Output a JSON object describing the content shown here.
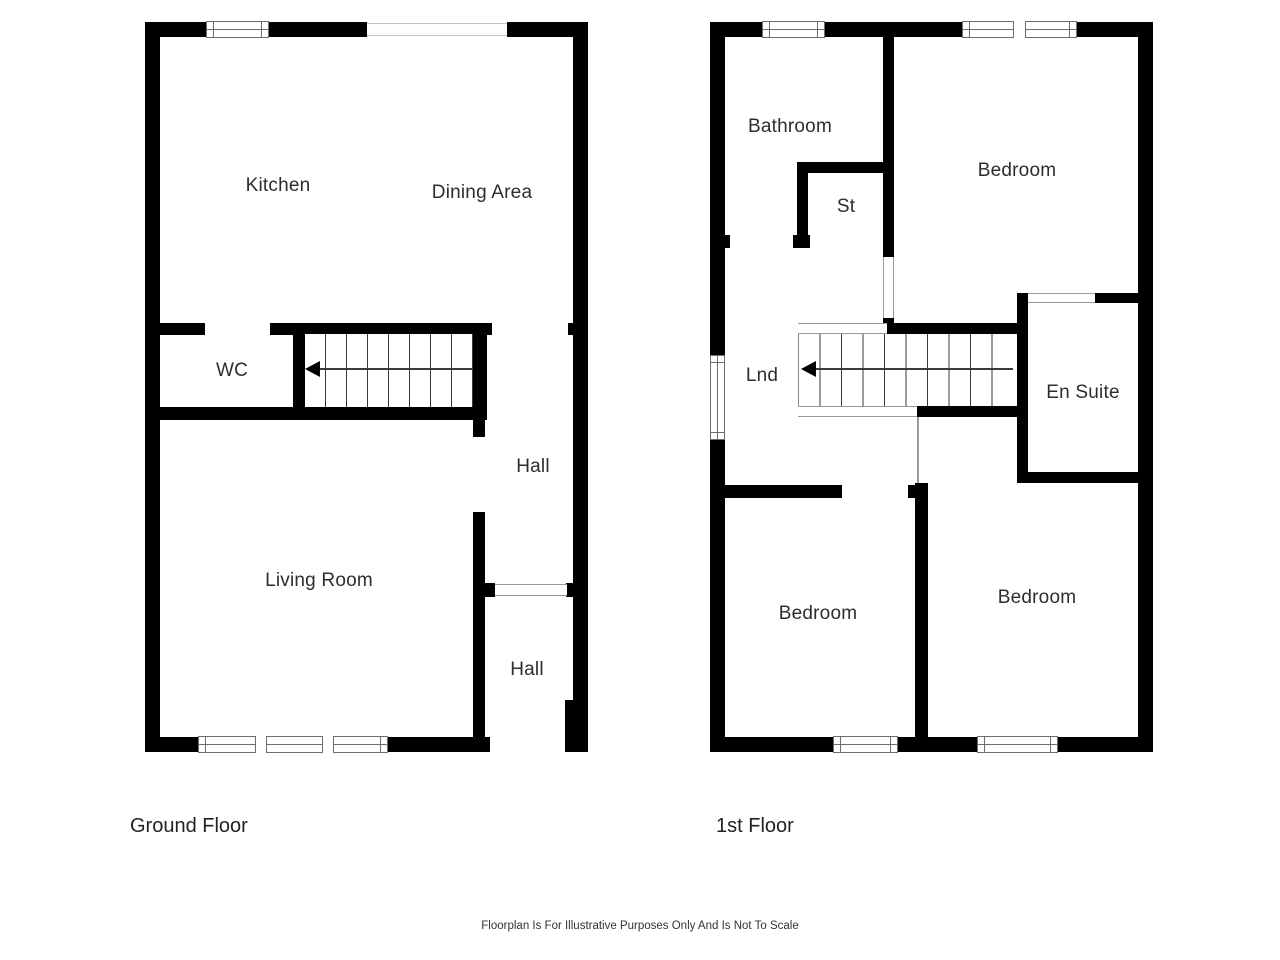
{
  "colors": {
    "wall": "#000000",
    "tread_line": "#3a3a3a",
    "window_line": "#6e6e6e",
    "threshold_line": "#9a9a9a",
    "text": "#2d2d2d",
    "background": "#ffffff"
  },
  "footer": {
    "disclaimer": "Floorplan Is For Illustrative Purposes Only And Is Not To Scale"
  },
  "ground_floor": {
    "caption": "Ground Floor",
    "rooms": [
      {
        "label": "Kitchen"
      },
      {
        "label": "Dining Area"
      },
      {
        "label": "WC"
      },
      {
        "label": "Hall"
      },
      {
        "label": "Living Room"
      },
      {
        "label": "Hall"
      }
    ],
    "stairs": {
      "treads": 8,
      "direction": "left"
    }
  },
  "first_floor": {
    "caption": "1st Floor",
    "rooms": [
      {
        "label": "Bathroom"
      },
      {
        "label": "Bedroom"
      },
      {
        "label": "St"
      },
      {
        "label": "Lnd"
      },
      {
        "label": "En Suite"
      },
      {
        "label": "Bedroom"
      },
      {
        "label": "Bedroom"
      }
    ],
    "stairs": {
      "treads": 10,
      "direction": "left"
    }
  }
}
